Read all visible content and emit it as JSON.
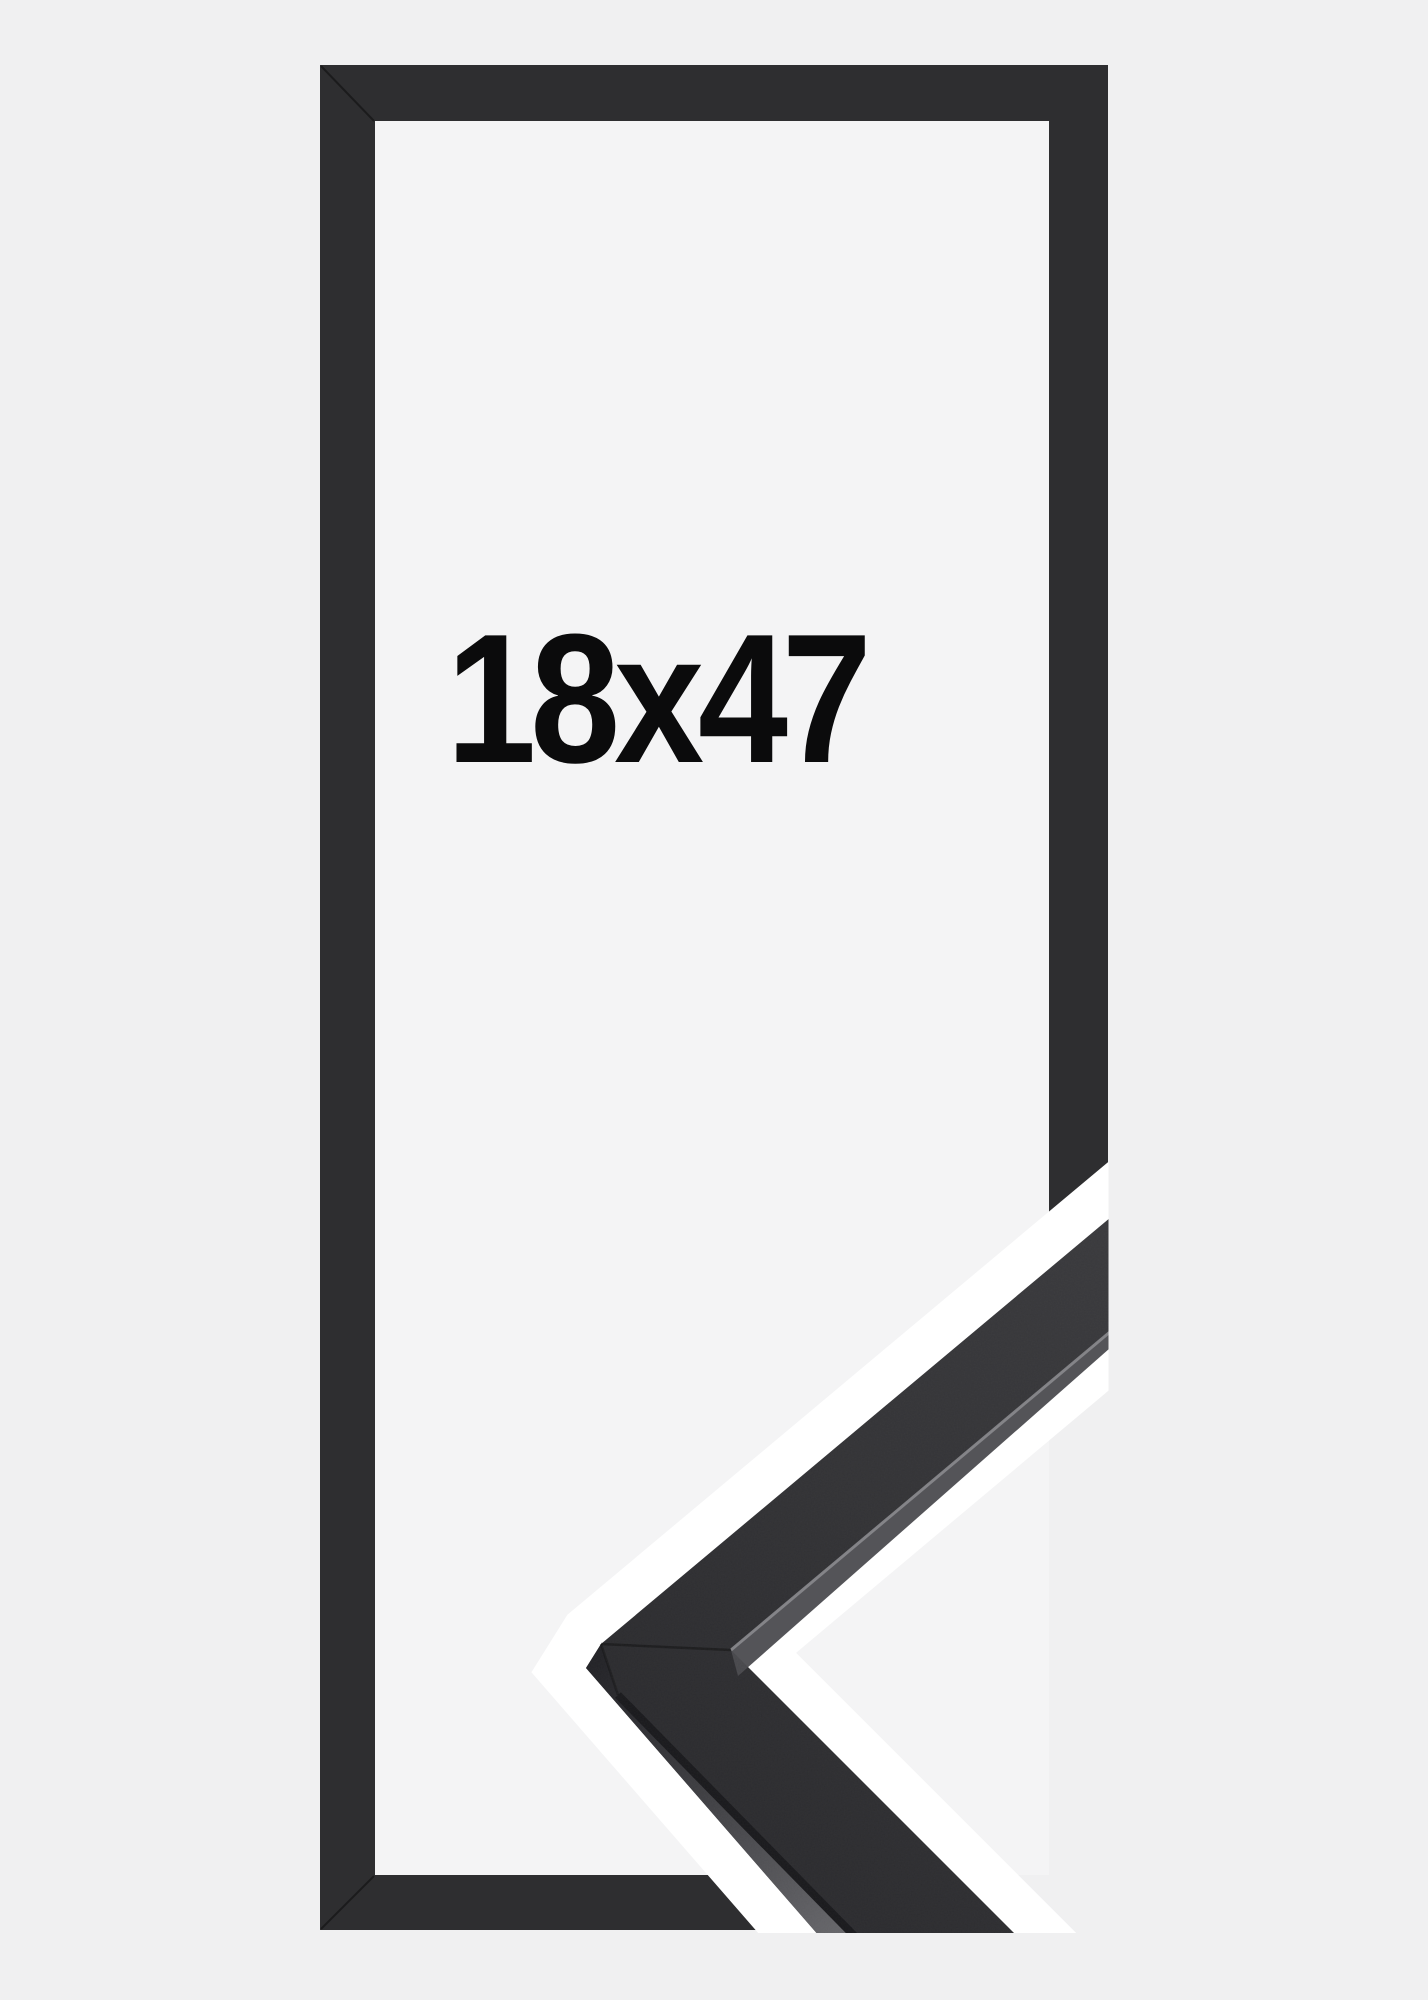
{
  "product": {
    "size_label": "18x47",
    "description": "Picture frame size preview with photographed corner sample"
  },
  "image": {
    "background_color": "#f0f0f1",
    "frame_inner_background": "#f4f4f5",
    "label_color": "#0b0b0c",
    "frame": {
      "fill": "#2e2e30",
      "seam_color": "rgba(0,0,0,0.4)"
    },
    "corner_sample": {
      "outline_color": "#ffffff",
      "top_face_light": "#3a3a3d",
      "top_face": "#333336",
      "top_face_dark": "#2c2c2f",
      "side_face_dark": "#232327",
      "side_face_mid": "#3f3f43",
      "side_face_light": "#69696d",
      "lip_face": "#4b4b4f",
      "edge_highlight": "#8a8a8e",
      "edge_dark": "#1a1a1d",
      "seam_color": "rgba(10,10,12,0.45)"
    }
  }
}
